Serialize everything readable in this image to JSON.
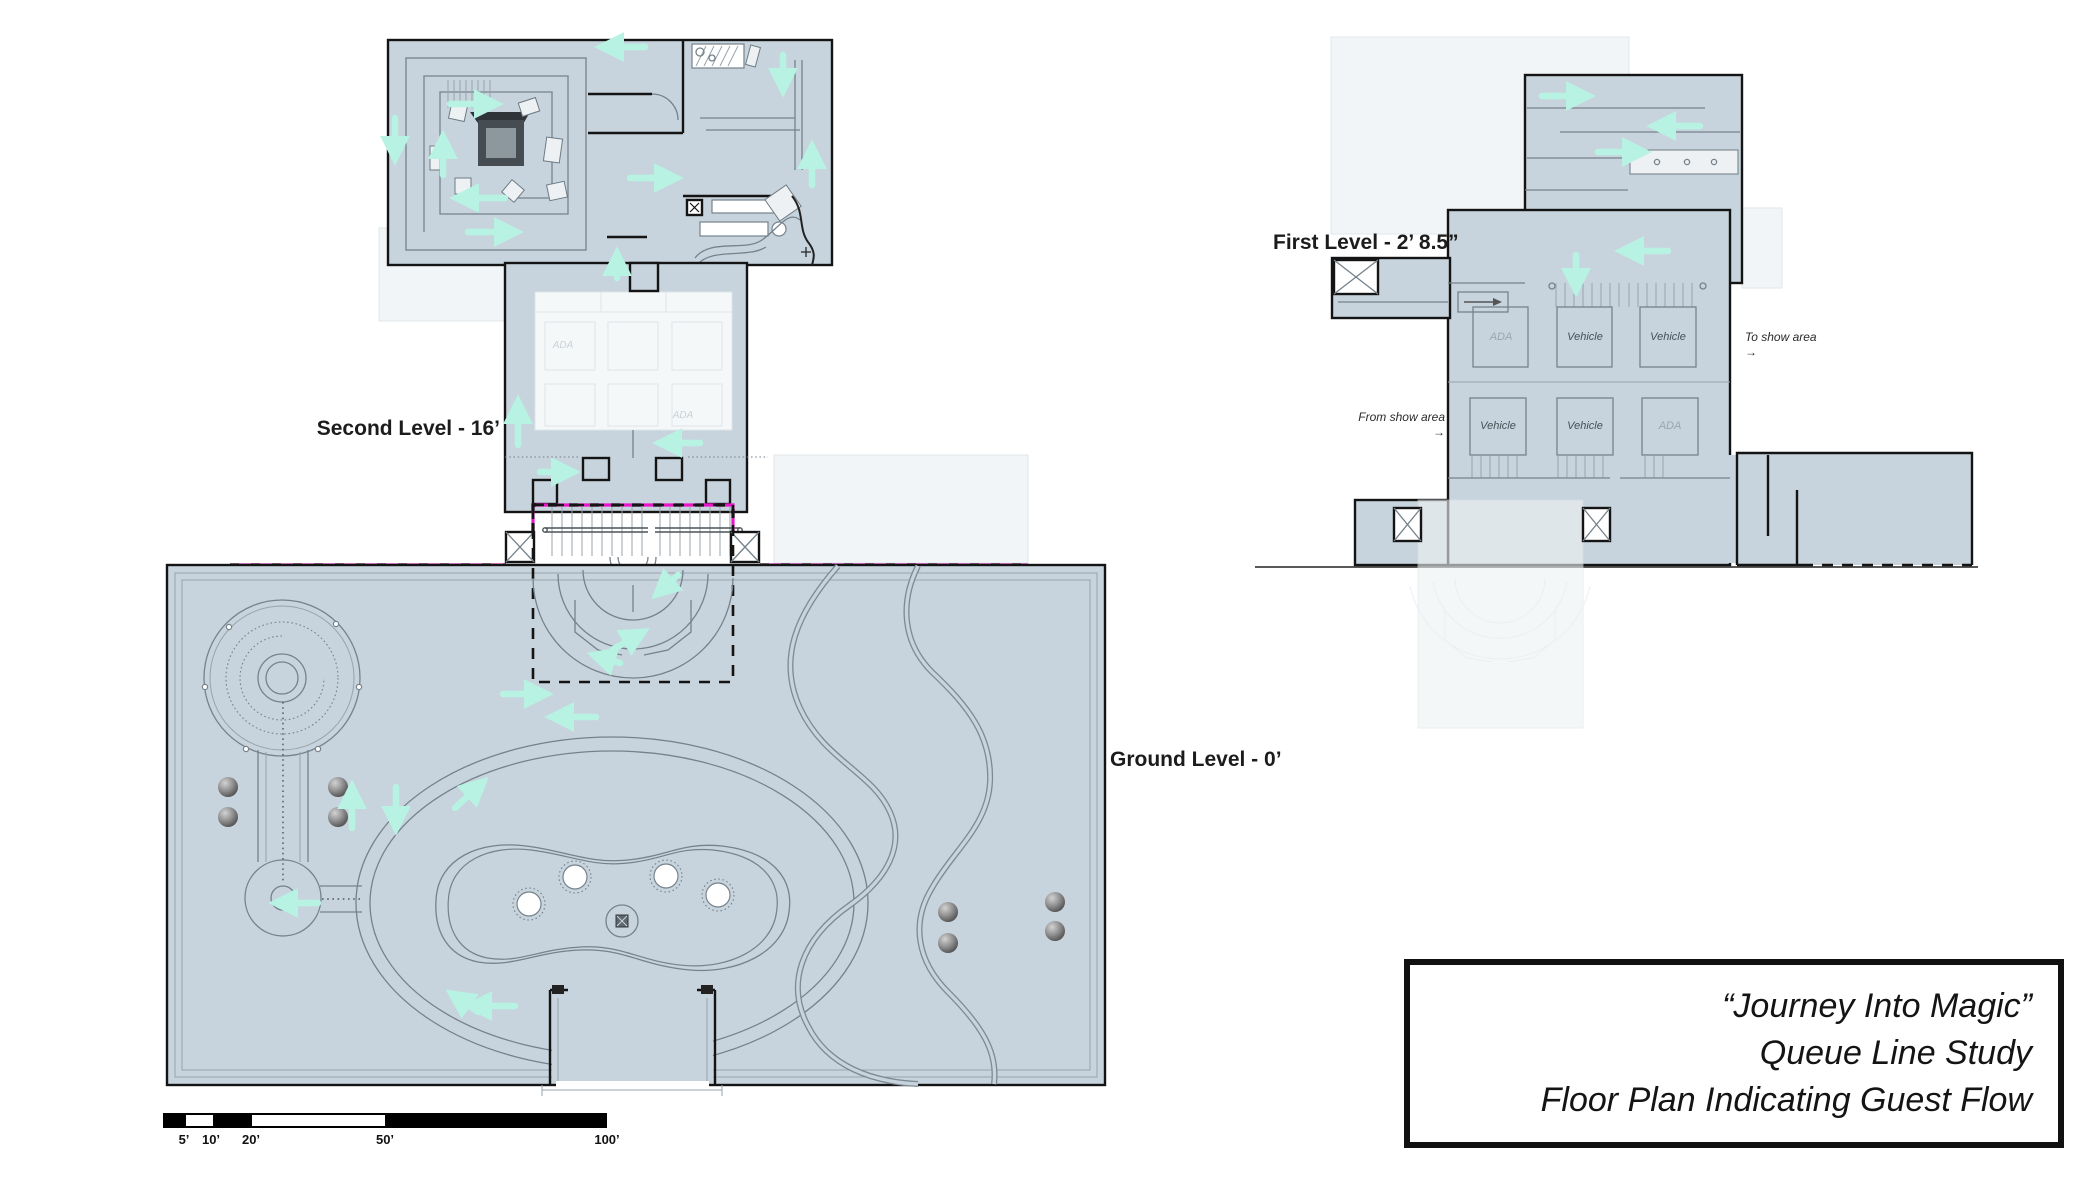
{
  "title_block": {
    "line1": "“Journey Into Magic”",
    "line2": "Queue Line Study",
    "line3": "Floor Plan Indicating Guest Flow"
  },
  "levels": {
    "second": {
      "label": "Second Level - 16’"
    },
    "first": {
      "label": "First Level - 2’ 8.5”"
    },
    "ground": {
      "label": "Ground Level - 0’"
    }
  },
  "first_level": {
    "bays_top": [
      "ADA",
      "Vehicle",
      "Vehicle"
    ],
    "bays_bottom": [
      "Vehicle",
      "Vehicle",
      "ADA"
    ],
    "to_show_area": "To show area",
    "from_show_area": "From show area",
    "arrow": "→"
  },
  "second_level": {
    "ghost_bays": [
      "ADA",
      "ADA"
    ]
  },
  "scale_bar": {
    "ticks": [
      "5’",
      "10’",
      "20’",
      "50’",
      "100’"
    ]
  },
  "icons": {
    "elevator_shaft": "crossed-box",
    "flow_arrow": "cyan-arrow",
    "level_connection": "magenta-dashed-line"
  },
  "colors": {
    "plan_fill": "#c7d4dd",
    "wall": "#141414",
    "detail_line": "#75828b",
    "flow_arrow": "#b7f2e2",
    "level_link": "#e916c9",
    "ghost_fill": "#f2f5f7"
  }
}
